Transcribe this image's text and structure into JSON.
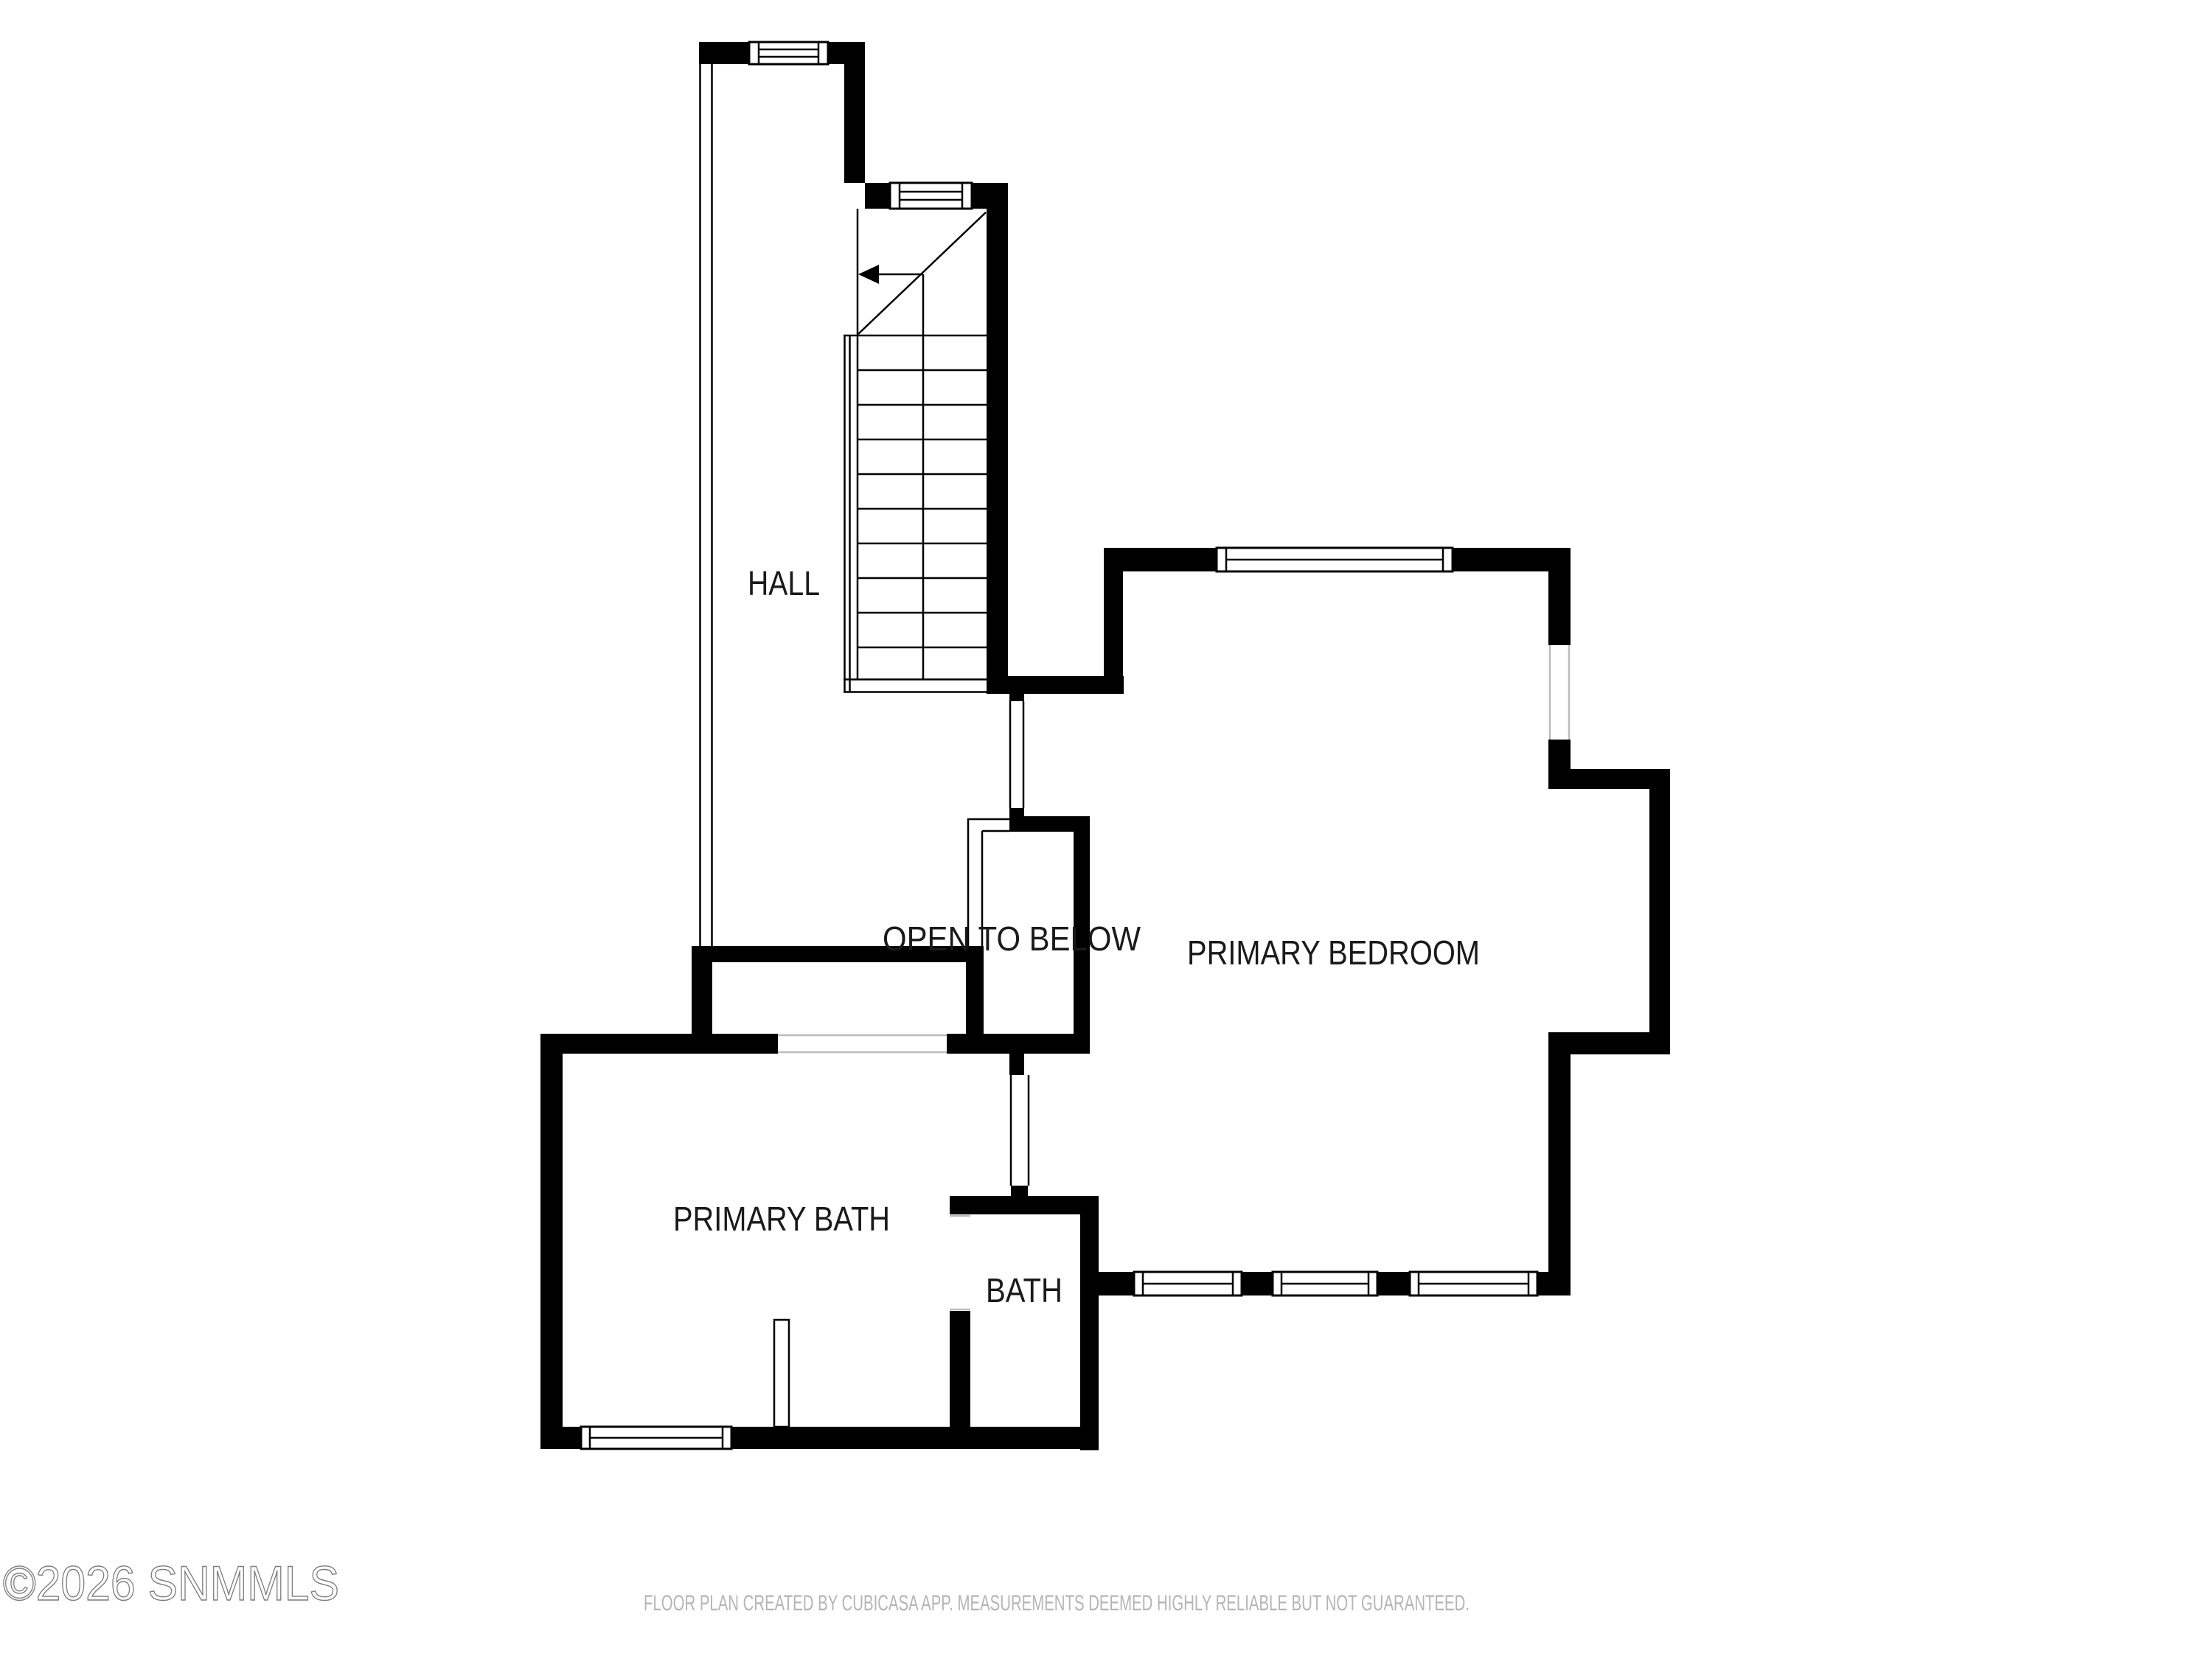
{
  "rooms": {
    "hall": "HALL",
    "open_to_below": "OPEN TO BELOW",
    "primary_bedroom": "PRIMARY BEDROOM",
    "primary_bath": "PRIMARY BATH",
    "bath": "BATH"
  },
  "watermark": "©2026 SNMMLS",
  "disclaimer": "FLOOR PLAN CREATED BY CUBICASA APP. MEASUREMENTS DEEMED HIGHLY RELIABLE BUT NOT GUARANTEED.",
  "icons": {
    "stair_direction": "left-arrow"
  },
  "colors": {
    "wall": "#000000",
    "room_label": "#1a1a1a",
    "watermark_stroke": "#7d7d7d",
    "disclaimer_text": "#b5b5b5",
    "opening_line": "#bcbcbc",
    "background": "#ffffff"
  }
}
